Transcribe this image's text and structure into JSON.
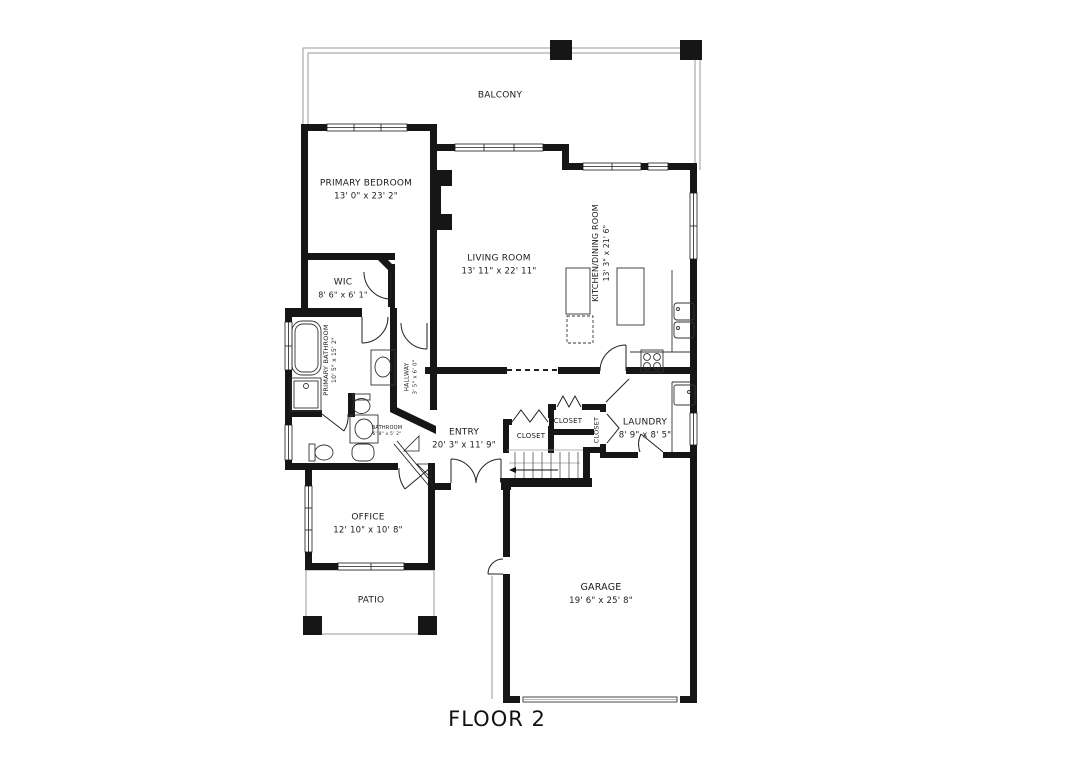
{
  "title": "FLOOR 2",
  "colors": {
    "wall": "#161616",
    "line": "#2a2a2a",
    "light_line": "#9a9a9a"
  },
  "rooms": {
    "balcony": {
      "name": "BALCONY"
    },
    "primary_bedroom": {
      "name": "PRIMARY BEDROOM",
      "dims": "13' 0\" x 23' 2\""
    },
    "living_room": {
      "name": "LIVING ROOM",
      "dims": "13' 11\" x 22' 11\""
    },
    "kitchen_dining": {
      "name": "KITCHEN/DINING ROOM",
      "dims": "13' 3\" x 21' 6\""
    },
    "wic": {
      "name": "WIC",
      "dims": "8' 6\" x 6' 1\""
    },
    "primary_bathroom": {
      "name": "PRIMARY BATHROOM",
      "dims": "10' 5\" x 15' 2\""
    },
    "hallway": {
      "name": "HALLWAY",
      "dims": "3' 5\" x 6' 0\""
    },
    "bathroom": {
      "name": "BATHROOM",
      "dims": "6' 8\" x 5' 2\""
    },
    "entry": {
      "name": "ENTRY",
      "dims": "20' 3\" x 11' 9\""
    },
    "closet_1": {
      "name": "CLOSET"
    },
    "closet_2": {
      "name": "CLOSET"
    },
    "closet_3": {
      "name": "CLOSET"
    },
    "laundry": {
      "name": "LAUNDRY",
      "dims": "8' 9\" x 8' 5\""
    },
    "office": {
      "name": "OFFICE",
      "dims": "12' 10\" x 10' 8\""
    },
    "patio": {
      "name": "PATIO"
    },
    "garage": {
      "name": "GARAGE",
      "dims": "19' 6\" x 25' 8\""
    }
  }
}
